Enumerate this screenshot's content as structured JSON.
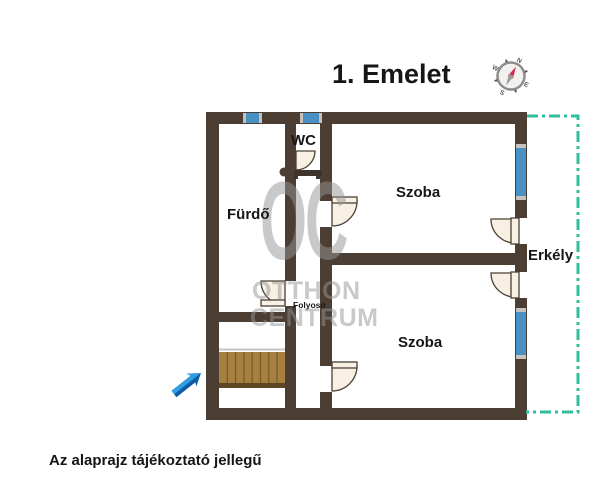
{
  "title": "1. Emelet",
  "rooms": {
    "wc": "WC",
    "bathroom": "Fürdő",
    "room_top": "Szoba",
    "room_bottom": "Szoba",
    "balcony": "Erkély",
    "hallway": "Folyosó"
  },
  "compass": {
    "north": "N",
    "east": "E",
    "south": "S",
    "west": "W"
  },
  "watermark": {
    "logo": "OC",
    "line1": "OTTHON",
    "line2": "CENTRUM"
  },
  "disclaimer": "Az alaprajz tájékoztató jellegű",
  "icons": {
    "compass": "compass-icon",
    "entry_arrow": "entry-arrow-icon"
  },
  "colors": {
    "wall": "#4d3e34",
    "window_blue": "#4a91c3",
    "window_cap_gray": "#c6c3be",
    "balcony_line_teal": "#2ebd9d",
    "door_fill": "#f8f1e3",
    "stairs_wood": "#a5803e",
    "stairs_edge": "#5e4524",
    "arrow_light_blue": "#2f9fe0",
    "arrow_dark_blue": "#0d5ca8",
    "compass_needle_red": "#d62a4e",
    "text_black": "#161616",
    "watermark_gray": "#949494"
  }
}
